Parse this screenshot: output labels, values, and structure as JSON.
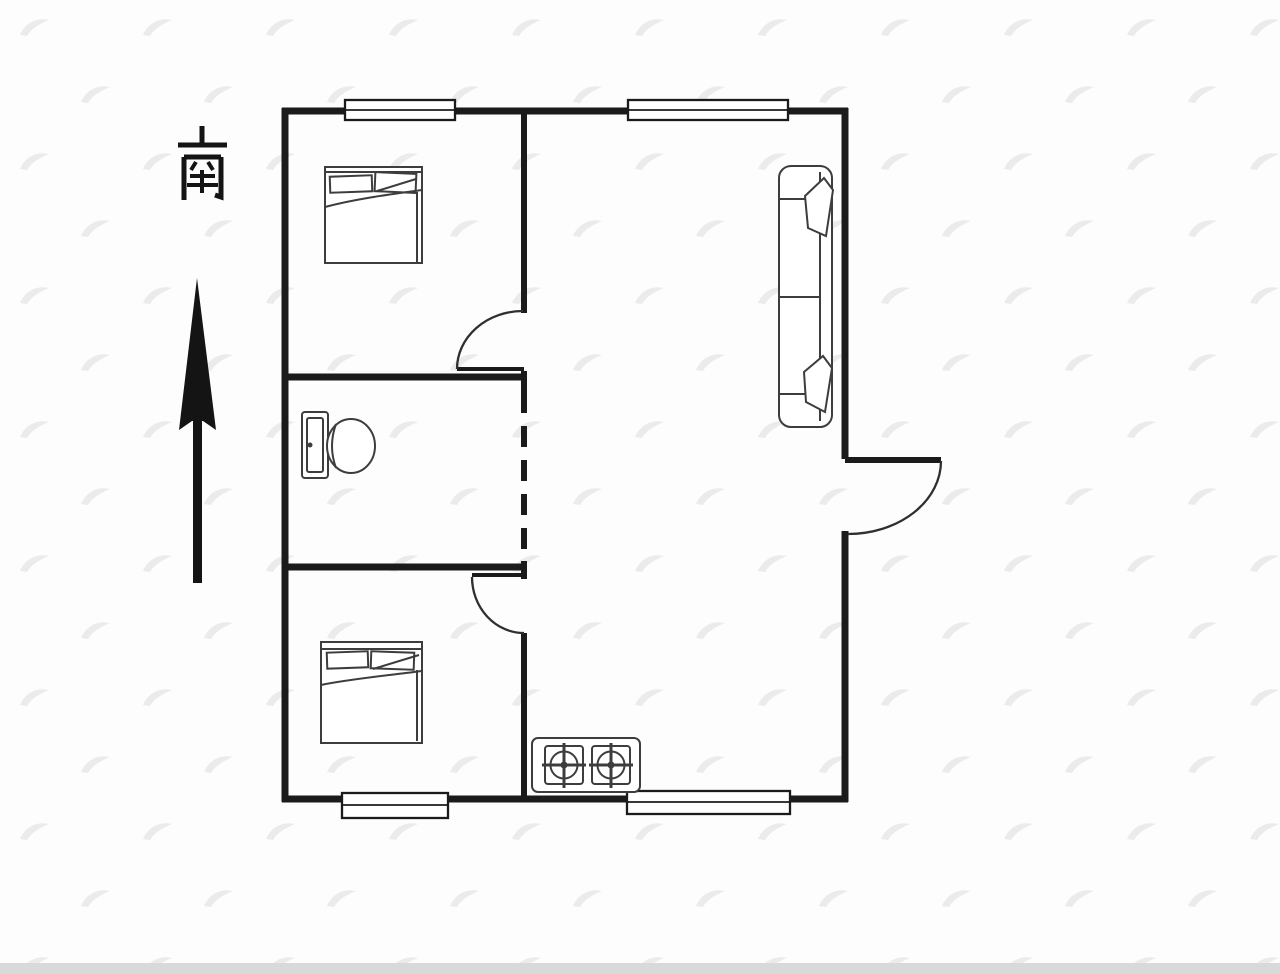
{
  "compass": {
    "label": "南"
  },
  "icons": {
    "names": [
      "south-label",
      "north-arrow-icon",
      "window",
      "interior-door",
      "entrance-door",
      "double-bed-icon",
      "sofa-icon",
      "toilet-icon",
      "gas-stove-icon",
      "watermark-icon"
    ]
  },
  "colors": {
    "wall": "#1b1b1b",
    "furniture": "#3d3d3d",
    "door": "#2f2f2f",
    "watermark": "#ebebeb",
    "background": "#fdfdfd",
    "bottom_strip": "#d9d9d9",
    "compass_text": "#141414"
  }
}
